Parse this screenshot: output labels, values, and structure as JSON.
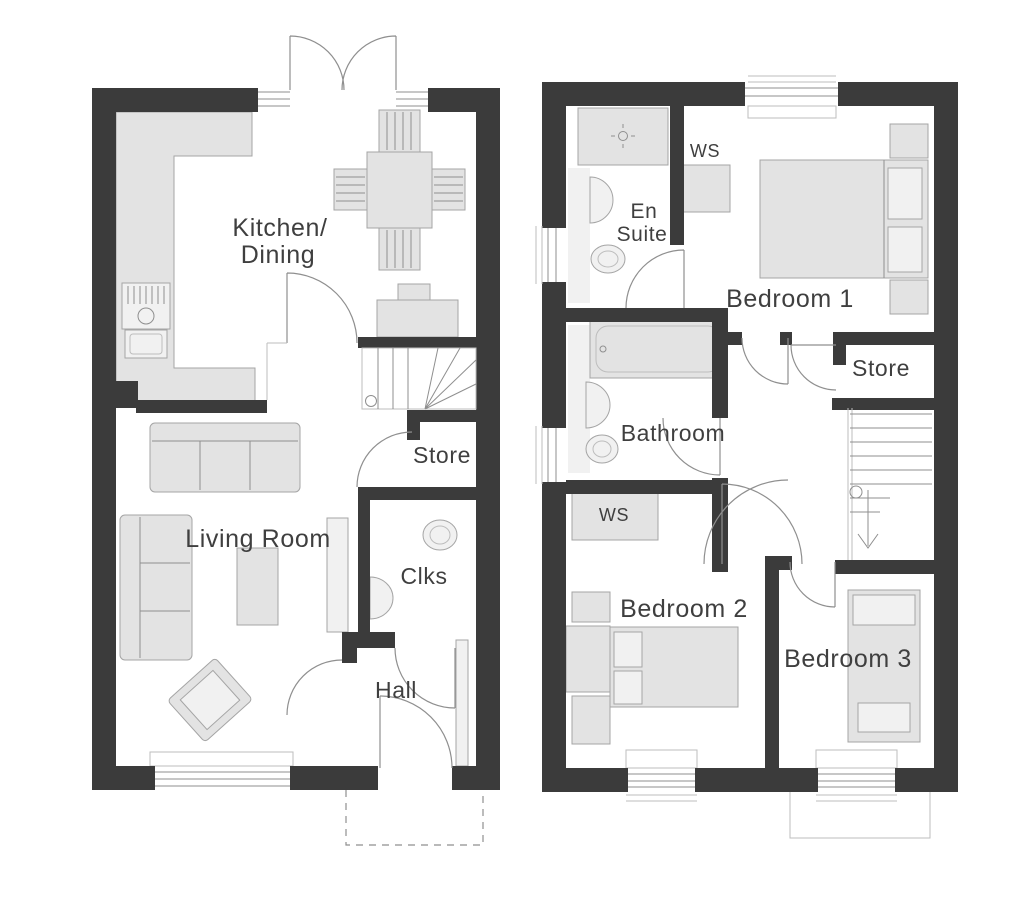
{
  "document_type": "house-floor-plan",
  "colors": {
    "background": "#ffffff",
    "wall": "#3b3b3b",
    "furniture_fill": "#e3e3e3",
    "furniture_fill_light": "#f1f1f1",
    "furniture_stroke": "#a5a5a5",
    "line": "#8f8f8f",
    "line_light": "#bdbdbd",
    "label": "#3f3f3f"
  },
  "ground_floor": {
    "labels": {
      "kitchen_dining_line1": "Kitchen/",
      "kitchen_dining_line2": "Dining",
      "store": "Store",
      "living_room": "Living Room",
      "cloakroom": "Clks",
      "hall": "Hall"
    }
  },
  "first_floor": {
    "labels": {
      "wardrobe_top": "WS",
      "en_suite_line1": "En",
      "en_suite_line2": "Suite",
      "bedroom_1": "Bedroom 1",
      "store": "Store",
      "bathroom": "Bathroom",
      "wardrobe_mid": "WS",
      "bedroom_2": "Bedroom 2",
      "bedroom_3": "Bedroom 3"
    }
  }
}
